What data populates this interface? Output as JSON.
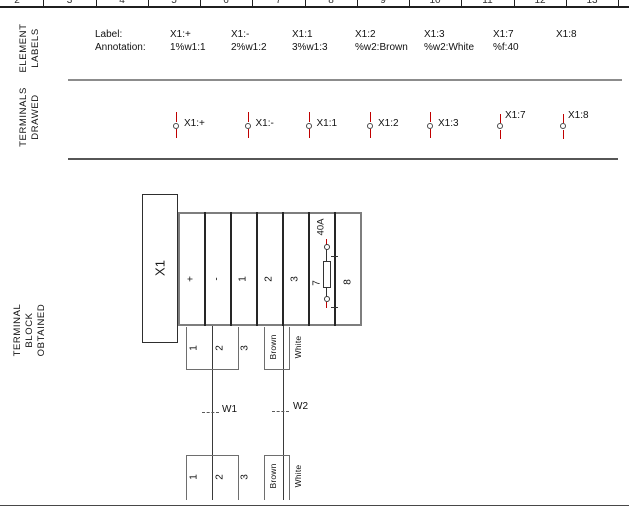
{
  "ruler": {
    "numbers": [
      "2",
      "3",
      "4",
      "5",
      "6",
      "7",
      "8",
      "9",
      "10",
      "11",
      "12",
      "13"
    ]
  },
  "row_headers": {
    "element_labels": "ELEMENT\nLABELS",
    "terminals_drawed": "TERMINALS\nDRAWED",
    "terminal_block": "TERMINAL\nBLOCK\nOBTAINED"
  },
  "element_labels": {
    "caption_label": "Label:",
    "caption_annotation": "Annotation:",
    "columns": [
      {
        "label": "X1:+",
        "annotation": "1%w1:1"
      },
      {
        "label": "X1:-",
        "annotation": "2%w1:2"
      },
      {
        "label": "X1:1",
        "annotation": "3%w1:3"
      },
      {
        "label": "X1:2",
        "annotation": "%w2:Brown"
      },
      {
        "label": "X1:3",
        "annotation": "%w2:White"
      },
      {
        "label": "X1:7",
        "annotation": "%f:40"
      },
      {
        "label": "X1:8",
        "annotation": ""
      }
    ]
  },
  "terminals_drawed": {
    "terminals": [
      {
        "label": "X1:+"
      },
      {
        "label": "X1:-"
      },
      {
        "label": "X1:1"
      },
      {
        "label": "X1:2"
      },
      {
        "label": "X1:3"
      },
      {
        "label": "X1:7"
      },
      {
        "label": "X1:8"
      }
    ]
  },
  "terminal_block": {
    "name": "X1",
    "cells": [
      {
        "label": "+"
      },
      {
        "label": "-"
      },
      {
        "label": "1"
      },
      {
        "label": "2"
      },
      {
        "label": "3"
      },
      {
        "label": "7"
      },
      {
        "label": "8"
      }
    ],
    "fuse_rating": "40A",
    "cables": [
      {
        "name": "W1",
        "wires": [
          "1",
          "2",
          "3"
        ]
      },
      {
        "name": "W2",
        "wires": [
          "Brown",
          "White"
        ]
      }
    ]
  },
  "colors": {
    "terminal_symbol_line": "#c00000",
    "diagram_line": "#333333",
    "section_divider": "#8c8c8c"
  }
}
